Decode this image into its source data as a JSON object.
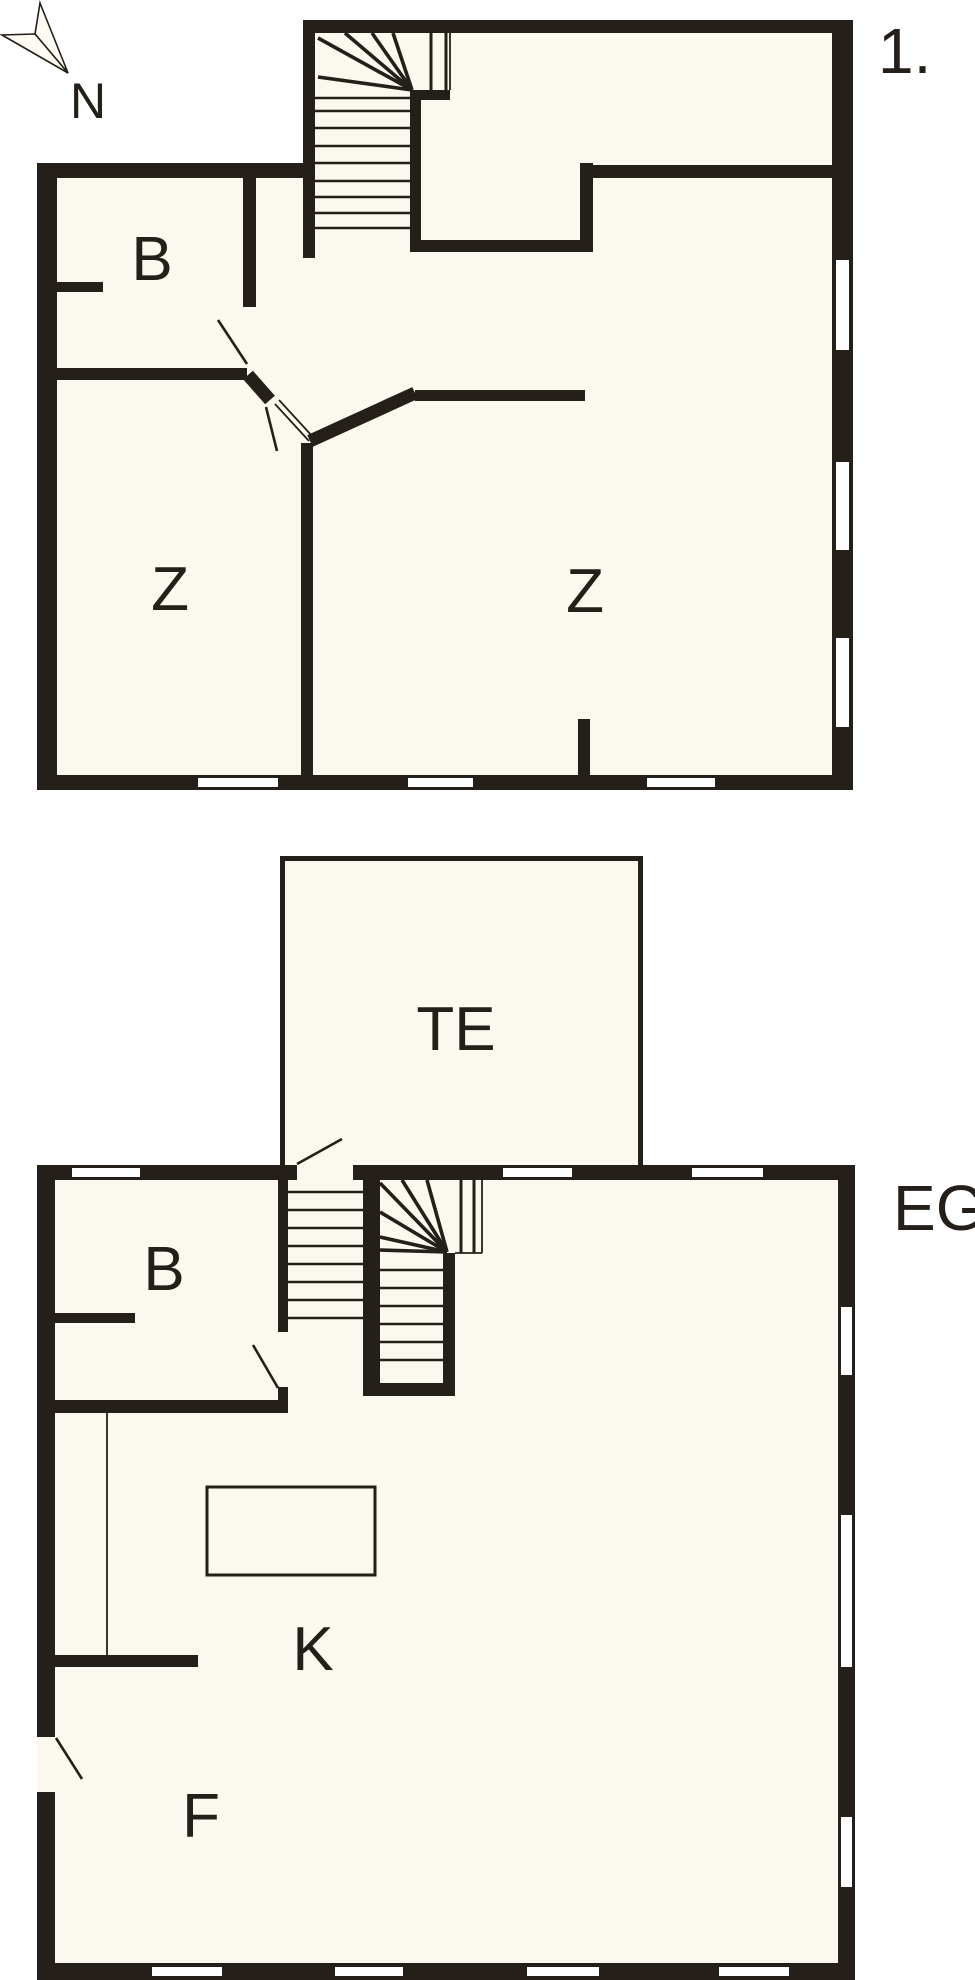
{
  "page": {
    "background": "#ffffff",
    "wall_color": "#242019",
    "floor_color": "#faf8ef",
    "window_color": "#ffffff"
  },
  "compass": {
    "label": "N"
  },
  "upper_floor": {
    "name_label": "1.",
    "room_labels": {
      "bath": "B",
      "bedroom_left": "Z",
      "bedroom_right": "Z"
    }
  },
  "ground_floor": {
    "name_label": "EG",
    "room_labels": {
      "bath": "B",
      "kitchen": "K",
      "hall": "F",
      "terrace": "TE"
    }
  }
}
